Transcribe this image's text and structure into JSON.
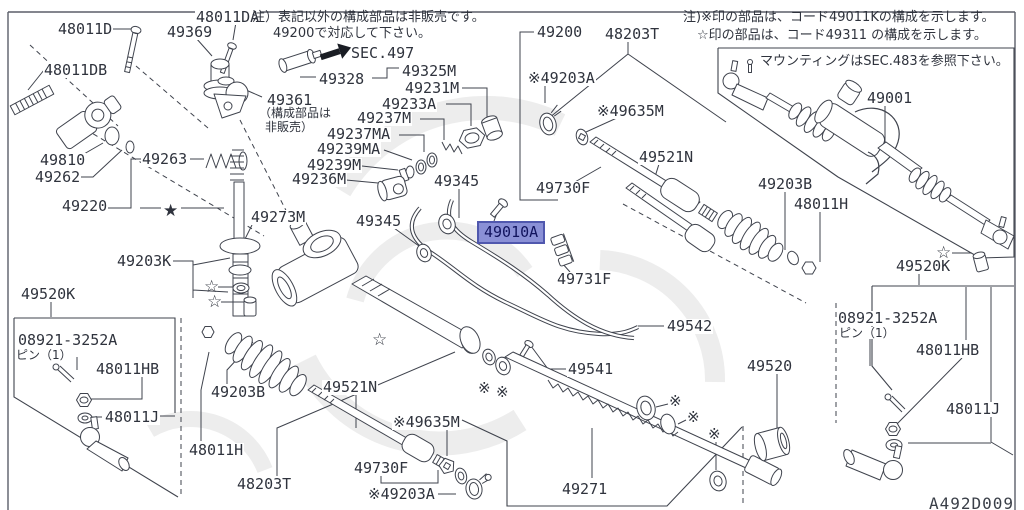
{
  "page": {
    "diagram_code": "A492D009",
    "line_color": "#3f434d",
    "text_color": "#2f333d"
  },
  "notes": {
    "left1": "注）表記以外の構成部品は非販売です。",
    "left2": "49200で対応して下さい。",
    "sec497": "SEC.497",
    "right1": "注)※印の部品は、コード49011Kの構成を示します。",
    "right2": "☆印の部品は、コード49311 の構成を示します。",
    "mounting": "マウンティングはSEC.483を参照下さい。"
  },
  "highlight": {
    "text": "49010A",
    "x": 477,
    "y": 221,
    "bg": "#8a90d6",
    "border": "#5058ae",
    "color": "#12145e"
  },
  "labels": [
    {
      "text": "48011D",
      "x": 57,
      "y": 22
    },
    {
      "text": "48011DA",
      "x": 195,
      "y": 10
    },
    {
      "text": "49369",
      "x": 166,
      "y": 25
    },
    {
      "text": "48011DB",
      "x": 43,
      "y": 63
    },
    {
      "text": "49328",
      "x": 318,
      "y": 72
    },
    {
      "text": "49325M",
      "x": 401,
      "y": 64
    },
    {
      "text": "49231M",
      "x": 404,
      "y": 81
    },
    {
      "text": "49233A",
      "x": 381,
      "y": 97
    },
    {
      "text": "49237M",
      "x": 356,
      "y": 111
    },
    {
      "text": "49237MA",
      "x": 326,
      "y": 127
    },
    {
      "text": "49239MA",
      "x": 316,
      "y": 142
    },
    {
      "text": "49239M",
      "x": 306,
      "y": 158
    },
    {
      "text": "49236M",
      "x": 291,
      "y": 172
    },
    {
      "text": "49361",
      "x": 266,
      "y": 93
    },
    {
      "text": "（構成部品は",
      "x": 258,
      "y": 107,
      "cls": "jp",
      "i": false
    },
    {
      "text": "非販売）",
      "x": 264,
      "y": 121,
      "cls": "jp",
      "i": false
    },
    {
      "text": "49810",
      "x": 39,
      "y": 153
    },
    {
      "text": "49262",
      "x": 34,
      "y": 170
    },
    {
      "text": "49263",
      "x": 141,
      "y": 152
    },
    {
      "text": "49220",
      "x": 61,
      "y": 199
    },
    {
      "text": "49273M",
      "x": 250,
      "y": 210
    },
    {
      "text": "49203K",
      "x": 116,
      "y": 254
    },
    {
      "text": "49520K",
      "x": 20,
      "y": 287
    },
    {
      "text": "08921-3252A",
      "x": 17,
      "y": 333
    },
    {
      "text": "ピン（1）",
      "x": 15,
      "y": 349,
      "cls": "jp",
      "i": false
    },
    {
      "text": "48011HB",
      "x": 95,
      "y": 362
    },
    {
      "text": "48011J",
      "x": 104,
      "y": 410
    },
    {
      "text": "48011H",
      "x": 188,
      "y": 443
    },
    {
      "text": "49203B",
      "x": 210,
      "y": 385
    },
    {
      "text": "49521N",
      "x": 322,
      "y": 380
    },
    {
      "text": "※49635M",
      "x": 392,
      "y": 415
    },
    {
      "text": "49730F",
      "x": 353,
      "y": 461
    },
    {
      "text": "※49203A",
      "x": 367,
      "y": 487
    },
    {
      "text": "48203T",
      "x": 236,
      "y": 477
    },
    {
      "text": "49345",
      "x": 433,
      "y": 174
    },
    {
      "text": "49345",
      "x": 355,
      "y": 214
    },
    {
      "text": "49730F",
      "x": 535,
      "y": 181
    },
    {
      "text": "49731F",
      "x": 556,
      "y": 272
    },
    {
      "text": "49542",
      "x": 666,
      "y": 319
    },
    {
      "text": "49541",
      "x": 567,
      "y": 362
    },
    {
      "text": "49271",
      "x": 561,
      "y": 482
    },
    {
      "text": "49200",
      "x": 536,
      "y": 25
    },
    {
      "text": "48203T",
      "x": 604,
      "y": 27
    },
    {
      "text": "※49203A",
      "x": 527,
      "y": 71
    },
    {
      "text": "※49635M",
      "x": 596,
      "y": 104
    },
    {
      "text": "49521N",
      "x": 638,
      "y": 150
    },
    {
      "text": "49203B",
      "x": 757,
      "y": 177
    },
    {
      "text": "48011H",
      "x": 793,
      "y": 197
    },
    {
      "text": "49001",
      "x": 866,
      "y": 91
    },
    {
      "text": "49520K",
      "x": 895,
      "y": 259
    },
    {
      "text": "08921-3252A",
      "x": 837,
      "y": 311
    },
    {
      "text": "ピン（1）",
      "x": 838,
      "y": 327,
      "cls": "jp",
      "i": false
    },
    {
      "text": "48011HB",
      "x": 915,
      "y": 343
    },
    {
      "text": "48011J",
      "x": 945,
      "y": 402
    },
    {
      "text": "49520",
      "x": 746,
      "y": 359
    }
  ],
  "symbols": [
    {
      "t": "★",
      "x": 163,
      "y": 203,
      "n": "solid-star-marker"
    },
    {
      "t": "☆",
      "x": 204,
      "y": 279,
      "n": "star-marker"
    },
    {
      "t": "☆",
      "x": 207,
      "y": 294,
      "n": "star-marker"
    },
    {
      "t": "☆",
      "x": 372,
      "y": 332,
      "n": "star-marker"
    },
    {
      "t": "☆",
      "x": 936,
      "y": 245,
      "n": "star-marker"
    },
    {
      "t": "※",
      "x": 478,
      "y": 381,
      "n": "ref-marker"
    },
    {
      "t": "※",
      "x": 496,
      "y": 385,
      "n": "ref-marker"
    },
    {
      "t": "※",
      "x": 669,
      "y": 394,
      "n": "ref-marker"
    },
    {
      "t": "※",
      "x": 687,
      "y": 410,
      "n": "ref-marker"
    },
    {
      "t": "※",
      "x": 708,
      "y": 427,
      "n": "ref-marker"
    }
  ]
}
